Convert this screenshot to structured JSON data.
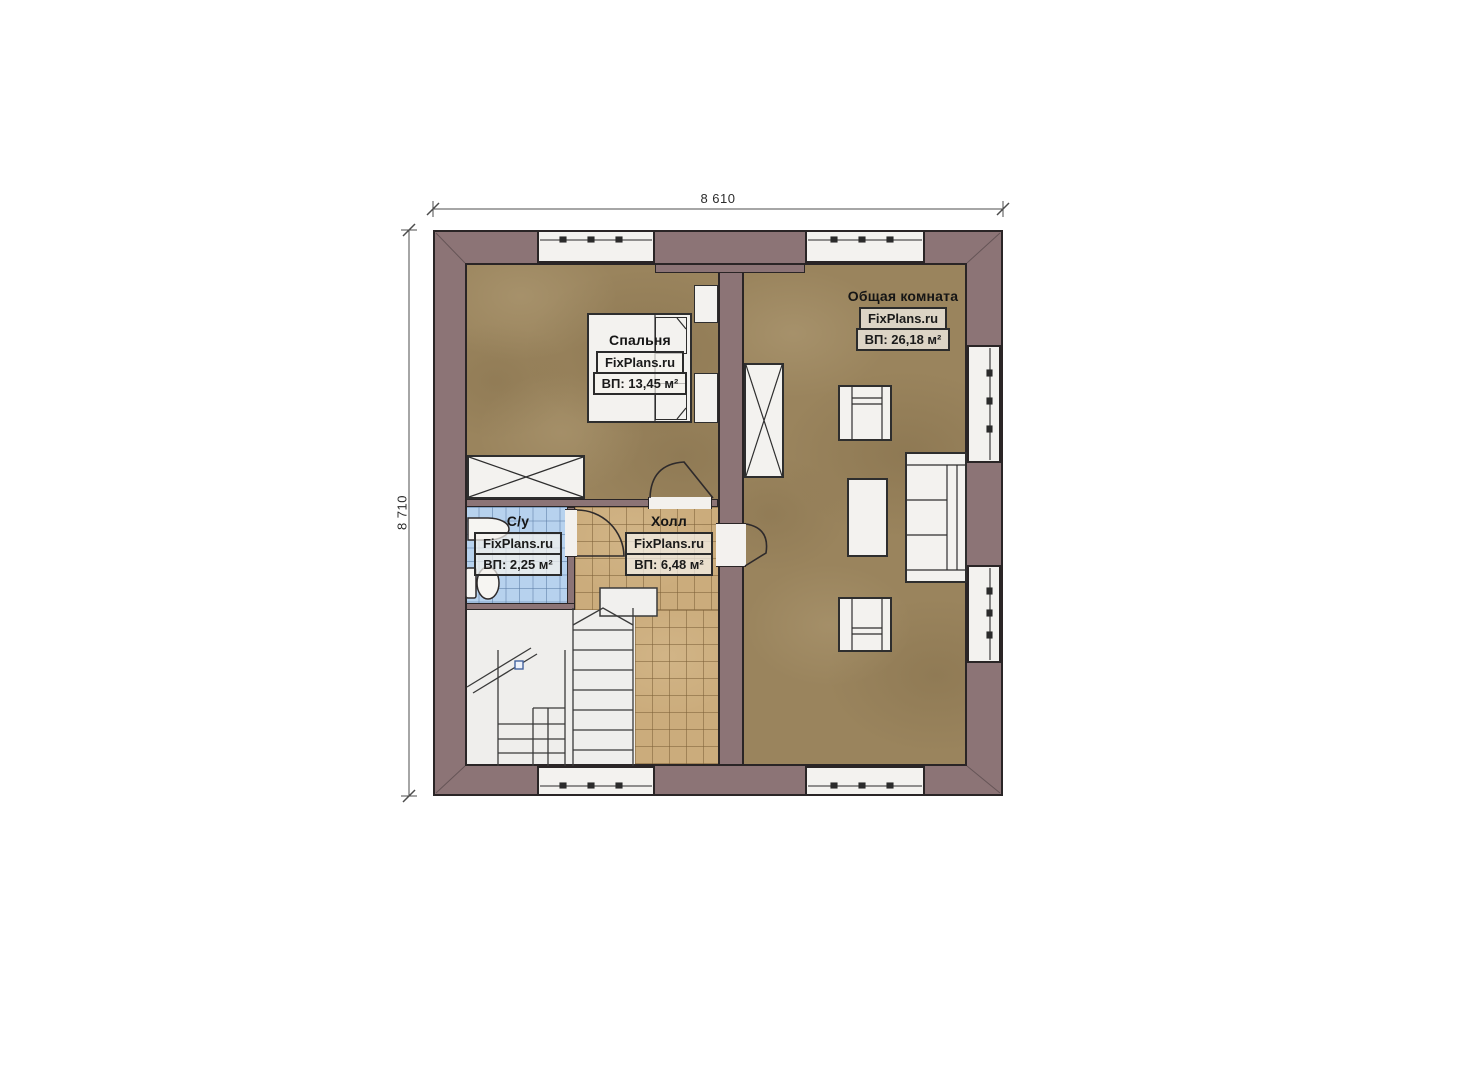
{
  "dimensions": {
    "width": "8 610",
    "height": "8 710"
  },
  "rooms": [
    {
      "name": "Спальня",
      "brand": "FixPlans.ru",
      "area": "ВП: 13,45 м²"
    },
    {
      "name": "Общая комната",
      "brand": "FixPlans.ru",
      "area": "ВП: 26,18 м²"
    },
    {
      "name": "С/у",
      "brand": "FixPlans.ru",
      "area": "ВП: 2,25 м²"
    },
    {
      "name": "Холл",
      "brand": "FixPlans.ru",
      "area": "ВП: 6,48 м²"
    }
  ],
  "colors": {
    "wall": "#8c7476",
    "outline": "#2a2526",
    "floor-wood": "#9a845d",
    "tile-hall": "#cbac7c",
    "tile-bath": "#b7d2ee",
    "fixture-white": "#f3f2ef",
    "stairs-floor": "#efeeec",
    "label-box-bg": "rgba(245,243,237,0.72)"
  }
}
